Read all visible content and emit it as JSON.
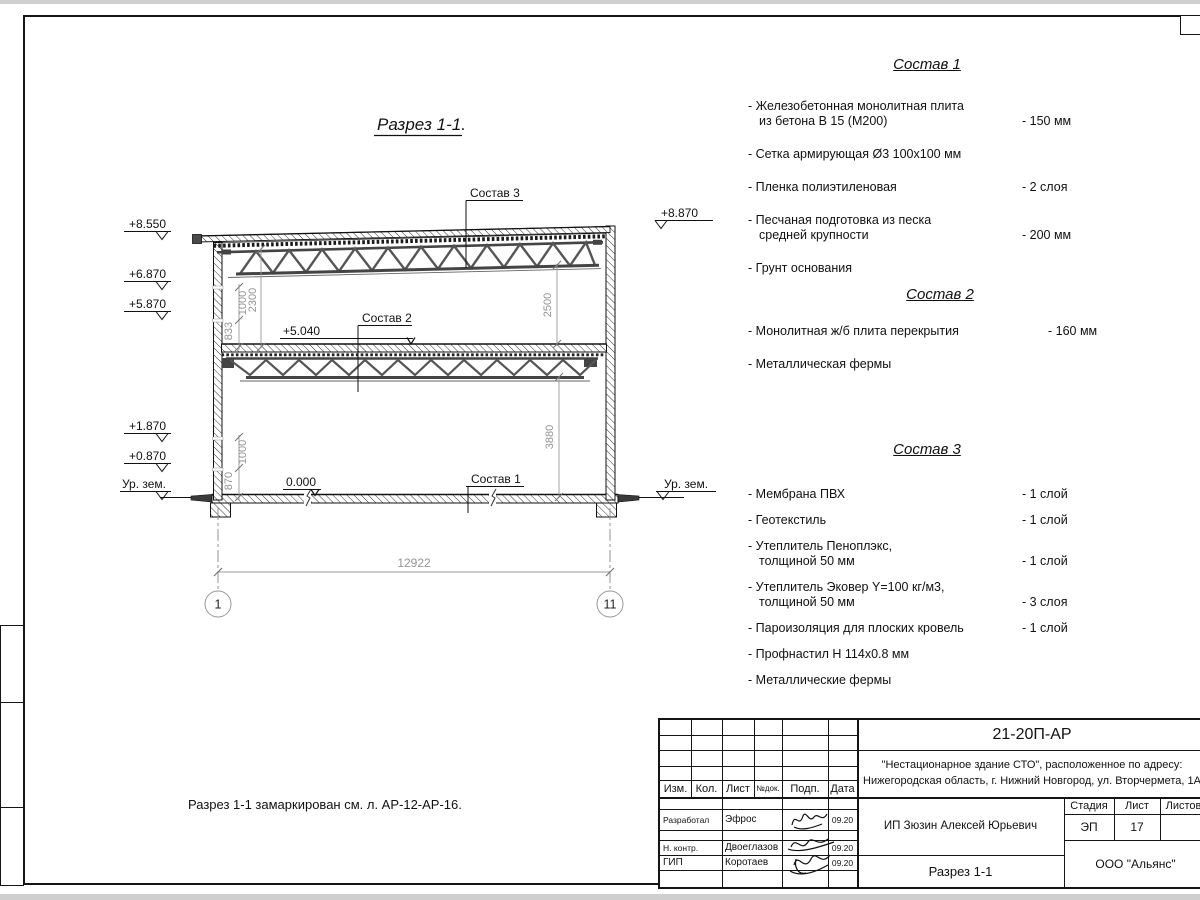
{
  "drawing": {
    "title": "Разрез 1-1.",
    "callouts": {
      "sostav1": "Состав 1",
      "sostav2": "Состав 2",
      "sostav3": "Состав 3"
    },
    "levels": {
      "mid": "+5.040",
      "zero": "0.000"
    },
    "elevations_left": [
      "+8.550",
      "+6.870",
      "+5.870",
      "+1.870",
      "+0.870",
      "Ур. зем."
    ],
    "elevations_right": {
      "top": "+8.870",
      "ground": "Ур. зем."
    },
    "dims": {
      "v2300": "2300",
      "v833": "833",
      "v1000a": "1000",
      "v870": "870",
      "v1000b": "1000",
      "v2500": "2500",
      "v3880": "3880",
      "span": "12922"
    },
    "axes": {
      "left": "1",
      "right": "11"
    }
  },
  "compositions": [
    {
      "title": "Состав 1",
      "items": [
        {
          "name": "- Железобетонная  монолитная плита\nиз бетона В 15 (М200)",
          "value": "- 150 мм"
        },
        {
          "name": "- Сетка армирующая Ø3 100х100 мм",
          "value": ""
        },
        {
          "name": "- Пленка полиэтиленовая",
          "value": "-  2 слоя"
        },
        {
          "name": "- Песчаная подготовка из песка\nсредней крупности",
          "value": "- 200 мм"
        },
        {
          "name": "- Грунт основания",
          "value": ""
        }
      ]
    },
    {
      "title": "Состав 2",
      "items": [
        {
          "name": "- Монолитная ж/б плита перекрытия",
          "value": "- 160 мм"
        },
        {
          "name": "- Металлическая фермы",
          "value": ""
        }
      ]
    },
    {
      "title": "Состав 3",
      "items": [
        {
          "name": "- Мембрана ПВХ",
          "value": "- 1 слой"
        },
        {
          "name": "- Геотекстиль",
          "value": "- 1 слой"
        },
        {
          "name": "- Утеплитель Пеноплэкс,\nтолщиной 50 мм",
          "value": "- 1 слой"
        },
        {
          "name": "- Утеплитель Эковер Y=100 кг/м3,\nтолщиной 50 мм",
          "value": "- 3 слоя"
        },
        {
          "name": "- Пароизоляция для плоских кровель",
          "value": "- 1 слой"
        },
        {
          "name": "- Профнастил Н 114х0.8 мм",
          "value": ""
        },
        {
          "name": "- Металлические фермы",
          "value": ""
        }
      ]
    }
  ],
  "note": "Разрез 1-1 замаркирован см. л. АР-12-АР-16.",
  "titleblock": {
    "code": "21-20П-АР",
    "project": "\"Нестационарное здание СТО\", расположенное по адресу:\nНижегородская область, г. Нижний Новгород, ул. Вторчермета, 1А",
    "client": "ИП Зюзин Алексей Юрьевич",
    "doc_title": "Разрез 1-1",
    "organization": "ООО \"Альянс\"",
    "stage_label": "Стадия",
    "sheet_label": "Лист",
    "sheets_label": "Листов",
    "stage": "ЭП",
    "sheet": "17",
    "cols": [
      "Изм.",
      "Кол.",
      "Лист",
      "№док.",
      "Подп.",
      "Дата"
    ],
    "rows": [
      {
        "role": "Разработал",
        "name": "Эфрос",
        "date": "09.20"
      },
      {
        "role": "Н. контр.",
        "name": "Двоеглазов",
        "date": "09.20"
      },
      {
        "role": "ГИП",
        "name": "Коротаев",
        "date": "09.20"
      }
    ]
  }
}
